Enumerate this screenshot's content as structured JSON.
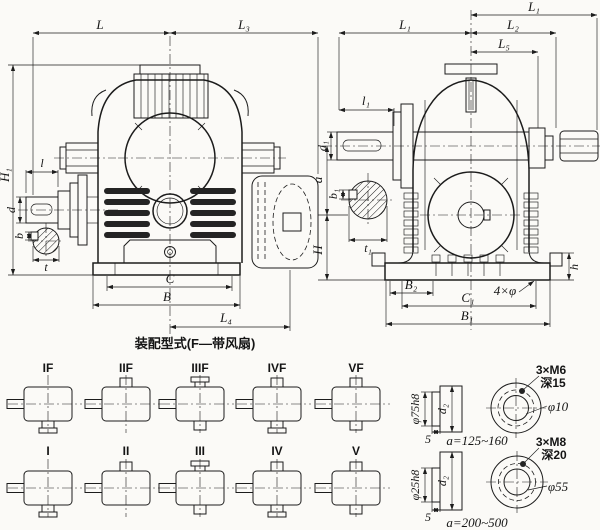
{
  "caption": "装配型式(F—带风扇)",
  "colors": {
    "ink": "#1c1c1c",
    "paper": "#fbfaf7"
  },
  "front": {
    "L": "L",
    "L3": "L₃",
    "H1": "H₁",
    "l": "l",
    "d": "d",
    "b": "b",
    "t": "t",
    "C": "C",
    "B": "B",
    "L4": "L₄"
  },
  "side": {
    "L1_top": "L₁",
    "L1": "L₁",
    "L2": "L₂",
    "L5": "L₅",
    "l1": "l₁",
    "d1": "d₁",
    "b1": "b₁",
    "t1": "t₁",
    "a": "a",
    "H": "H",
    "h": "h",
    "B2": "B₂",
    "C1": "C₁",
    "B1": "B₁",
    "holes": "4×φ"
  },
  "variants": {
    "fan": [
      "IF",
      "IIF",
      "IIIF",
      "IVF",
      "VF"
    ],
    "plain": [
      "I",
      "II",
      "III",
      "IV",
      "V"
    ]
  },
  "details": [
    {
      "shaft": "φ75h8",
      "plate": "5",
      "hub": "d₂",
      "range": "a=125~160",
      "screws": "3×M6",
      "depth": "深15",
      "bore": "φ10"
    },
    {
      "shaft": "φ25h8",
      "plate": "5",
      "hub": "d₂",
      "range": "a=200~500",
      "screws": "3×M8",
      "depth": "深20",
      "bore": "φ55"
    }
  ]
}
